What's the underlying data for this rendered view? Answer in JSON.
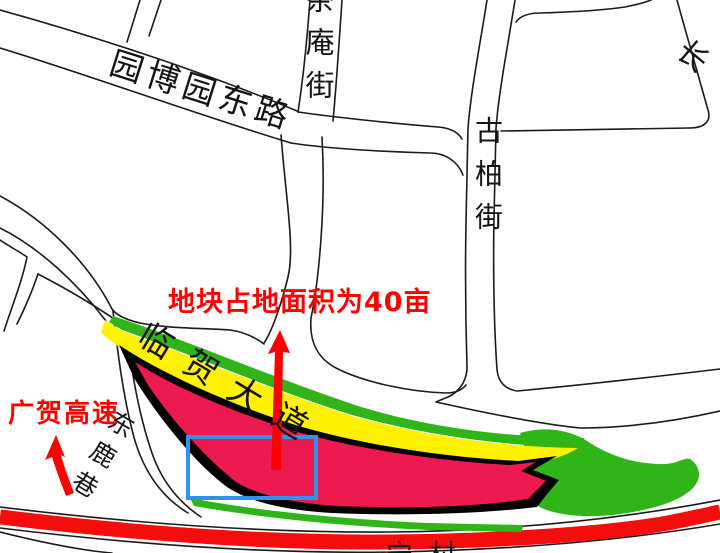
{
  "labels": {
    "yuanboyuan_east_road": "园博园东路",
    "chaan_street": "茶庵街",
    "gubai_street": "古柏街",
    "linhe_avenue": "临贺大道",
    "donglu_lane": "东鹿巷",
    "chang_partial": "长",
    "bottom_partial": "宁村"
  },
  "annotations": {
    "parcel_area_note": "地块占地面积为40亩",
    "highway_label": "广贺高速"
  },
  "colors": {
    "road_line": "#1a1a1a",
    "parcel_fill": "#EC1A4E",
    "parcel_outline": "#000000",
    "buffer_yellow": "#FFF100",
    "buffer_green": "#2FB517",
    "highway_red": "#F50D0D",
    "highlight_box_blue": "#2F93EC",
    "annotation_red": "#FF0000"
  }
}
